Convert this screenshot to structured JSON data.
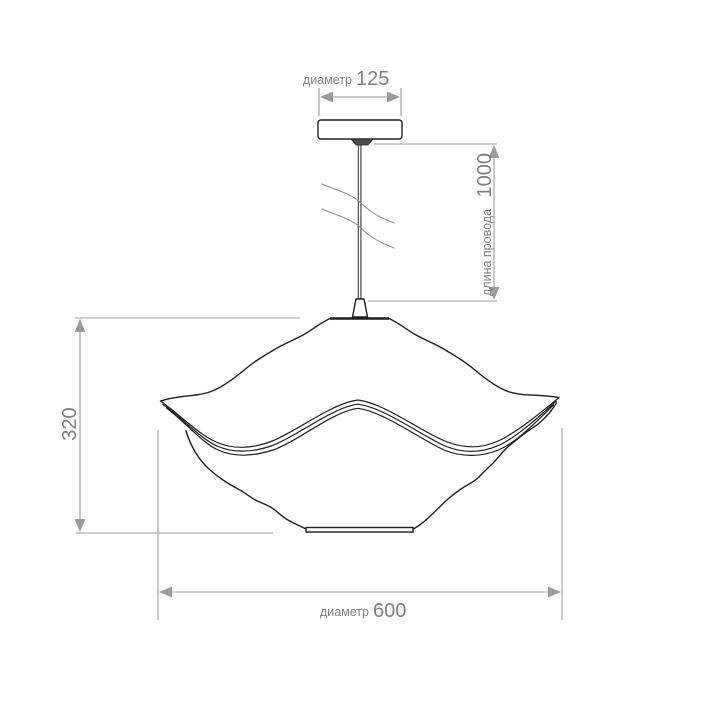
{
  "drawing": {
    "kind": "pendant-lamp-dimension-drawing",
    "dimensions": {
      "canopy_diameter": {
        "prefix": "диаметр",
        "value": "125"
      },
      "cord_length": {
        "prefix": "длина провода",
        "value": "1000"
      },
      "shade_height": {
        "value": "320"
      },
      "shade_diameter": {
        "prefix": "диаметр",
        "value": "600"
      }
    },
    "colors": {
      "background": "#ffffff",
      "lamp_outline": "#1f1f1f",
      "dimension_lines": "#9b9b9b",
      "dimension_text": "#7f7f7f"
    }
  }
}
